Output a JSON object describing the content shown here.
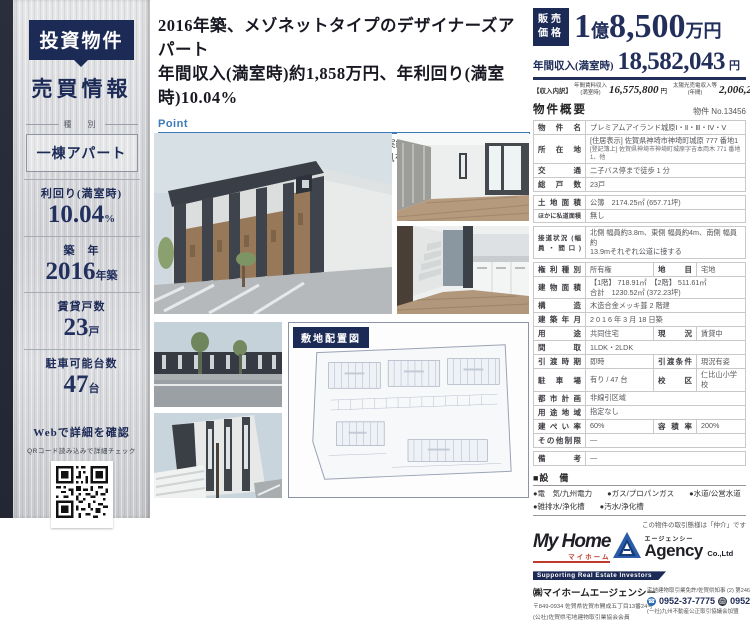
{
  "colors": {
    "navy": "#1c2a56",
    "price_navy": "#232f5b",
    "point_blue": "#3b7bb8",
    "red": "#c0392b"
  },
  "sidebar": {
    "tag": "投資物件",
    "subtitle": "売買情報",
    "type_label": "種　別",
    "type_value": "一棟アパート",
    "stats": [
      {
        "label": "利回り(満室時)",
        "value": "10.04",
        "unit": "%"
      },
      {
        "label": "築　年",
        "value": "2016",
        "unit": "年築"
      },
      {
        "label": "賃貸戸数",
        "value": "23",
        "unit": "戸"
      },
      {
        "label": "駐車可能台数",
        "value": "47",
        "unit": "台"
      }
    ],
    "web_label": "Webで詳細を確認",
    "qr_caption": "QRコード読み込みで詳細チェック"
  },
  "header": {
    "title_line1": "2016年築、メゾネットタイプのデザイナーズアパート",
    "title_line2": "年間収入(満室時)約1,858万円、年利回り(満室時)10.04%"
  },
  "point": {
    "heading": "Point",
    "items": [
      "・年間収入には太陽光売電収入額約200万円(令和元年実績)が含まれます。",
      "・外からの視線をシャットアウトしつつ、室内に光と風を取り込むライトコート付き",
      "・インターネット使い放題(入居者様無料)導入済み!"
    ]
  },
  "siteplan": {
    "label": "敷地配置図"
  },
  "price": {
    "tag_line1": "販売",
    "tag_line2": "価格",
    "num1": "1",
    "unit1": "億",
    "num2": "8,500",
    "unit2": "万円",
    "annual_label": "年間収入(満室時)",
    "annual_value": "18,582,043",
    "annual_unit": "円",
    "breakdown_tag": "【収入内訳】",
    "bd1_label1": "年間賃料収入",
    "bd1_label2": "(満室時)",
    "bd1_value": "16,575,800",
    "bd1_unit": "円",
    "bd2_label1": "太陽光売電収入等",
    "bd2_label2": "(年間)",
    "bd2_value": "2,006,243",
    "bd2_unit": "円"
  },
  "overview": {
    "heading": "物件概要",
    "property_no": "物件 No.13456",
    "rows": [
      {
        "label": "物件名",
        "value": "プレミアムアイランド城原Ⅰ・Ⅱ・Ⅲ・Ⅳ・Ⅴ"
      },
      {
        "label": "所在地",
        "value": "[住居表示] 佐賀県神埼市神埼町城原 777 番地1",
        "value2": "[登記簿上] 佐賀県神埼市神埼町城原字吉本両木 771 番地1、他"
      },
      {
        "label": "交通",
        "value": "二子バス停まで徒歩 1 分"
      },
      {
        "label": "総戸数",
        "value": "23戸"
      },
      {
        "label": "土地面積",
        "value": "公簿　2174.25㎡ (657.71坪)"
      },
      {
        "label": "ほかに私道面積",
        "value": "無し"
      },
      {
        "label": "接道状況 (幅員・間口)",
        "value": "北側 幅員約3.8m、東側 幅員約4m、南側 幅員約",
        "value2": "13.9mそれぞれ公道に接する"
      },
      {
        "label": "権利種別",
        "value": "所有権",
        "label2": "地　目",
        "value2": "宅地"
      },
      {
        "label": "建物面積",
        "value": "【1階】 718.91㎡　【2階】 511.61㎡",
        "value2": "合計　1230.52㎡ (372.23坪)"
      },
      {
        "label": "構　造",
        "value": "木造合金メッキ葺 2 階建"
      },
      {
        "label": "建築年月",
        "value": "2 0 1 6 年 3 月 18 日築"
      },
      {
        "label": "用　途",
        "value": "共同住宅",
        "label2": "現　況",
        "value2": "賃貸中"
      },
      {
        "label": "間　取",
        "value": "1LDK・2LDK"
      },
      {
        "label": "引渡時期",
        "value": "即時",
        "label2": "引渡条件",
        "value2": "現況有姿"
      },
      {
        "label": "駐車場",
        "value": "有り / 47 台",
        "label2": "校　区",
        "value2": "仁比山小学校"
      },
      {
        "label": "都市計画",
        "value": "非線引区域"
      },
      {
        "label": "用途地域",
        "value": "指定なし"
      },
      {
        "label": "建ぺい率",
        "value": "60%",
        "label2": "容積率",
        "value2": "200%"
      },
      {
        "label": "その他制限",
        "value": "―"
      },
      {
        "label": "備　考",
        "value": "―"
      }
    ]
  },
  "equipment": {
    "heading": "■設　備",
    "line1": "●電　気/九州電力　　●ガス/プロパンガス　　●水道/公営水道",
    "line2": "●雑排水/浄化槽　　●汚水/浄化槽"
  },
  "footer": {
    "deal_note": "この物件の取引態様は「仲介」です",
    "logo_myhome": "My Home",
    "logo_myhome_kana": "マイホーム",
    "logo_agency_kana": "エージェンシー",
    "logo_agency": "Agency",
    "logo_co": "Co.,Ltd",
    "tagline": "Supporting Real Estate Investors",
    "company": "㈱マイホームエージェンシー",
    "address": "〒849-0934 佐賀県佐賀市開成五丁目13番24号",
    "member1": "(公社)佐賀県宅地建物取引業協会会員",
    "license": "宅地建物取引業免許/佐賀県知事 (2) 第2467号",
    "tel": "0952-37-7775",
    "fax": "0952-37-9996",
    "member2": "(一社)九州不動産公正取引協議会加盟"
  }
}
